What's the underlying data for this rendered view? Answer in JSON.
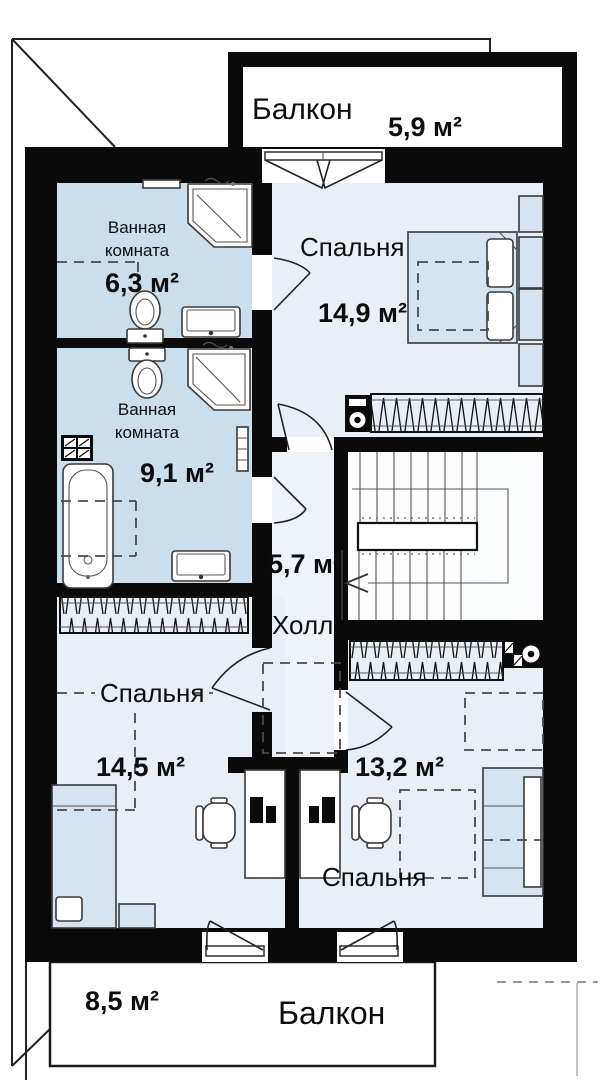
{
  "colors": {
    "wall": "#0a0a0a",
    "bathroom_fill": "#cbdeec",
    "room_fill": "#e9eff7",
    "hall_fill": "#eef3f9",
    "stair_fill": "#fcfdfe",
    "furniture_fill": "#d6e3f0"
  },
  "rooms": {
    "balcony_top": {
      "name": "Балкон",
      "area": "5,9 м²"
    },
    "bathroom_top": {
      "name": "Ванная комната",
      "area": "6,3 м²"
    },
    "bedroom_main": {
      "name": "Спальня",
      "area": "14,9 м²"
    },
    "bathroom_bottom": {
      "name": "Ванная комната",
      "area": "9,1 м²"
    },
    "hall": {
      "name": "Холл",
      "area": "5,7 м²"
    },
    "bedroom_left": {
      "name": "Спальня",
      "area": "14,5 м²"
    },
    "bedroom_right": {
      "name": "Спальня",
      "area": "13,2 м²"
    },
    "balcony_bottom": {
      "name": "Балкон",
      "area": "8,5 м²"
    }
  },
  "fixtures": {
    "corner_shower": "corner-shower-cabin",
    "toilet": "toilet",
    "sink": "washbasin",
    "bathtub": "bathtub",
    "towel_radiator": "towel-radiator",
    "vent_grille": "ventilation-grille",
    "vent_fan": "ventilation-fan",
    "washing_machine": "washing-machine",
    "radiator": "radiator-hatched",
    "double_bed": "double-bed",
    "single_bed": "single-bed",
    "nightstand": "nightstand",
    "desk": "desk-with-computer",
    "chair": "office-chair",
    "wardrobe": "wardrobe-dashed",
    "stairs": "staircase-with-direction-arrow",
    "door": "swing-door",
    "balcony_door": "french-balcony-door"
  }
}
